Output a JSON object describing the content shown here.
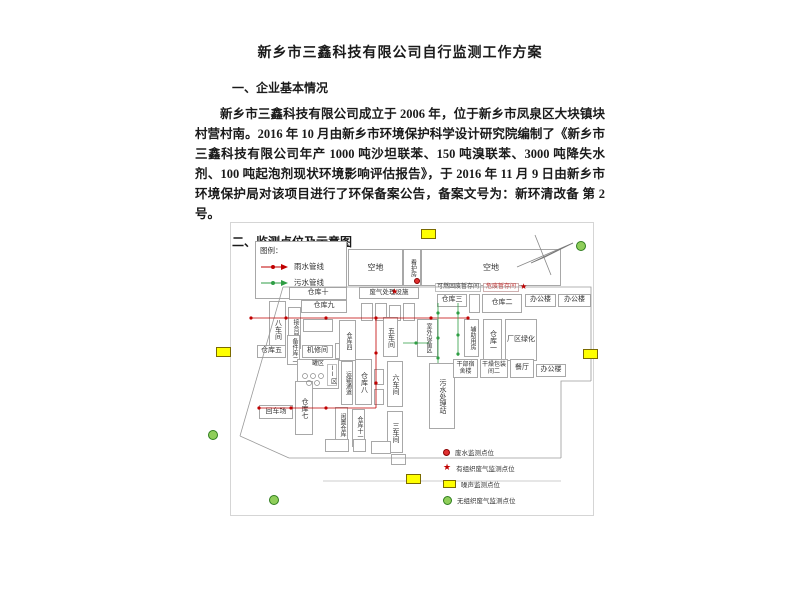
{
  "doc": {
    "title": "新乡市三鑫科技有限公司自行监测工作方案",
    "heading1": "一、企业基本情况",
    "para1": "新乡市三鑫科技有限公司成立于 2006 年，位于新乡市凤泉区大块镇块村营村南。2016 年 10 月由新乡市环境保护科学设计研究院编制了《新乡市三鑫科技有限公司年产 1000 吨沙坦联苯、150 吨溴联苯、3000 吨降失水剂、100 吨起泡剂现状环境影响评估报告》，于 2016 年 11 月 9 日由新乡市环境保护局对该项目进行了环保备案公告，备案文号为：新环清改备 第 2 号。",
    "heading2": "二、监测点位及示意图"
  },
  "figure": {
    "map_legend": {
      "title": "图例：",
      "rain_label": "雨水管线",
      "sewage_label": "污水管线"
    },
    "top_areas": {
      "open_left": "空地",
      "guard_room": "看护房",
      "open_right": "空地"
    },
    "buildings": {
      "warehouse10": "仓库十",
      "warehouse9": "仓库九",
      "workshop8": "八车间",
      "joint_room": "接合间",
      "warehouse5": "仓库五",
      "spare_parts2": "备件库二",
      "repair_room": "机修间",
      "tank_area": "罐区",
      "zone2": "II区",
      "transport_corridor": "运输通道",
      "warehouse4": "仓库四",
      "warehouse8": "仓库八",
      "idle_warehouse": "闲置仓库",
      "warehouse11": "仓库十一",
      "turn_yard": "回车场",
      "warehouse7": "仓库七",
      "workshop6": "六车间",
      "workshop3": "三车间",
      "workshop5": "五车间",
      "outdoor_equipment": "室外设备区",
      "sewage_station": "污水处理站",
      "auxiliary_room": "辅助用房",
      "warehouse1": "仓库一",
      "greening": "厂区绿化",
      "dormitory": "干部宿舍楼",
      "drying_packing2": "干燥包装间二",
      "canteen": "餐厅",
      "office_bottom": "办公楼",
      "gas_treatment": "废气处理设施",
      "combustible_waste": "可燃固废暂存间",
      "hazardous_waste": "危废暂存间",
      "warehouse3": "仓库三",
      "warehouse2": "仓库二",
      "office1": "办公楼",
      "office2": "办公楼"
    },
    "point_legend": {
      "wastewater": "废水监测点位",
      "organized_gas": "有组织废气监测点位",
      "noise": "噪声监测点位",
      "fugitive_gas": "无组织废气监测点位"
    },
    "colors": {
      "rain_line": "#c00000",
      "sewage_line": "#2f9e44",
      "noise_marker": "#ffff00",
      "fugitive_marker": "#8fce5a"
    }
  }
}
